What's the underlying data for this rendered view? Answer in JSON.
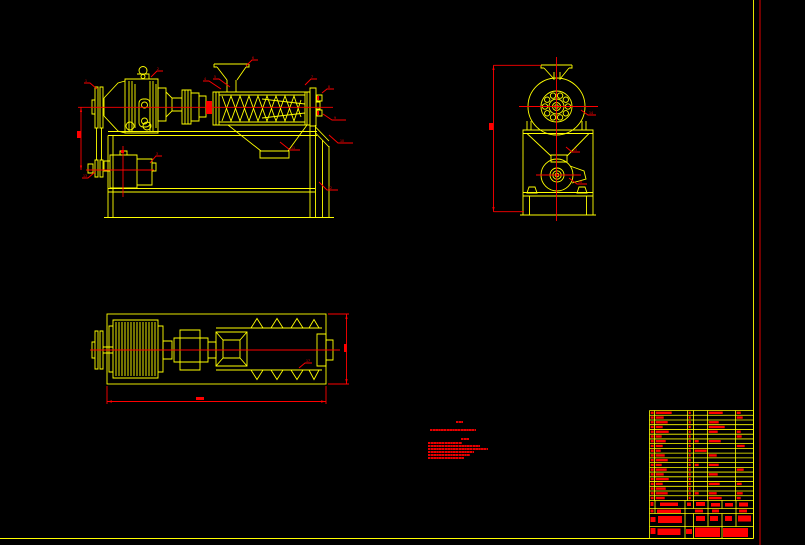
{
  "meta": {
    "background": "#000000",
    "line_color": "#ffff00",
    "accent_color": "#ff0000",
    "drawing_type": "CAD assembly drawing, screw press machine, three orthographic views",
    "text_legibility": "annotation text rendered too small to read at source resolution"
  },
  "sheet": {
    "border_right_x": 753.5,
    "border_bottom_y": 538.5,
    "outer_border_x": 760
  },
  "leaders": [
    {
      "n": "1",
      "pts": [
        [
          97,
          89
        ],
        [
          90,
          83
        ],
        [
          84,
          83
        ]
      ],
      "lx": 85,
      "ly": 82
    },
    {
      "n": "2",
      "pts": [
        [
          151,
          77
        ],
        [
          157,
          71
        ],
        [
          163,
          71
        ]
      ],
      "lx": 157,
      "ly": 70
    },
    {
      "n": "3",
      "pts": [
        [
          150,
          163
        ],
        [
          156,
          156
        ],
        [
          162,
          156
        ]
      ],
      "lx": 156,
      "ly": 155
    },
    {
      "n": "4",
      "pts": [
        [
          221,
          89
        ],
        [
          209,
          81
        ],
        [
          203,
          81
        ]
      ],
      "lx": 204,
      "ly": 80
    },
    {
      "n": "5",
      "pts": [
        [
          230,
          87
        ],
        [
          219,
          79
        ],
        [
          213,
          79
        ]
      ],
      "lx": 214,
      "ly": 78
    },
    {
      "n": "6",
      "pts": [
        [
          246,
          66
        ],
        [
          252,
          60
        ],
        [
          258,
          60
        ]
      ],
      "lx": 252,
      "ly": 59
    },
    {
      "n": "7",
      "pts": [
        [
          305,
          85
        ],
        [
          311,
          79
        ],
        [
          317,
          79
        ]
      ],
      "lx": 311,
      "ly": 78
    },
    {
      "n": "8",
      "pts": [
        [
          322,
          93
        ],
        [
          327,
          89
        ],
        [
          334,
          89
        ]
      ],
      "lx": 328,
      "ly": 88
    },
    {
      "n": "9",
      "pts": [
        [
          323,
          114
        ],
        [
          332,
          120
        ],
        [
          346,
          120
        ]
      ],
      "lx": 334,
      "ly": 119
    },
    {
      "n": "10",
      "pts": [
        [
          329,
          135
        ],
        [
          338,
          143
        ],
        [
          353,
          143
        ]
      ],
      "lx": 340,
      "ly": 142
    },
    {
      "n": "11",
      "pts": [
        [
          280,
          142
        ],
        [
          290,
          150
        ],
        [
          300,
          150
        ]
      ],
      "lx": 291,
      "ly": 149
    },
    {
      "n": "12",
      "pts": [
        [
          319,
          182
        ],
        [
          327,
          190
        ],
        [
          338,
          190
        ]
      ],
      "lx": 328,
      "ly": 189
    },
    {
      "n": "13",
      "pts": [
        [
          95,
          172
        ],
        [
          88,
          178
        ],
        [
          82,
          178
        ]
      ],
      "lx": 83,
      "ly": 177
    },
    {
      "n": "14",
      "pts": [
        [
          581,
          110
        ],
        [
          588,
          115
        ],
        [
          596,
          115
        ]
      ],
      "lx": 589,
      "ly": 114
    },
    {
      "n": "15",
      "pts": [
        [
          566,
          147
        ],
        [
          572,
          152
        ],
        [
          580,
          152
        ]
      ],
      "lx": 573,
      "ly": 151
    },
    {
      "n": "16",
      "pts": [
        [
          569,
          178
        ],
        [
          577,
          184
        ],
        [
          587,
          184
        ]
      ],
      "lx": 578,
      "ly": 183
    },
    {
      "n": "17",
      "pts": [
        [
          299,
          368
        ],
        [
          305,
          363
        ],
        [
          312,
          363
        ]
      ],
      "lx": 306,
      "ly": 362
    }
  ],
  "dim_texts": [
    [
      77,
      131,
      4,
      7
    ],
    [
      489,
      123,
      4,
      7
    ],
    [
      196,
      397,
      8,
      3
    ],
    [
      344,
      344,
      3,
      8
    ]
  ],
  "marks": [
    [
      206,
      101,
      6,
      13
    ],
    [
      317,
      96,
      2,
      4
    ],
    [
      317,
      111,
      2,
      4
    ],
    [
      121,
      150,
      3,
      3
    ],
    [
      650.5,
      502,
      3,
      4
    ],
    [
      660,
      502.5,
      18,
      3.5
    ],
    [
      687,
      502.5,
      4,
      3.5
    ],
    [
      696,
      502,
      9,
      4
    ],
    [
      711,
      503,
      9,
      3.5
    ],
    [
      725,
      503,
      8,
      3.5
    ],
    [
      739,
      502.5,
      9,
      4
    ],
    [
      650.5,
      509.5,
      3,
      3
    ],
    [
      657,
      509.5,
      24,
      3.5
    ],
    [
      695,
      509.5,
      8,
      3
    ],
    [
      712,
      509.5,
      7,
      3
    ],
    [
      739,
      509.5,
      8,
      3
    ],
    [
      658,
      516,
      24,
      7
    ],
    [
      650.5,
      517,
      5,
      5
    ],
    [
      696,
      516,
      9,
      5
    ],
    [
      710,
      516,
      8,
      5
    ],
    [
      725,
      516,
      7,
      5
    ],
    [
      738,
      515.5,
      13,
      6
    ],
    [
      650.5,
      528,
      5,
      6
    ],
    [
      657.5,
      528.5,
      23,
      6.5
    ],
    [
      686,
      529,
      6,
      5
    ],
    [
      695,
      527.5,
      25,
      9.5
    ],
    [
      723,
      528,
      25,
      9
    ]
  ],
  "notes": {
    "lines": [
      [
        456,
        420.5,
        7,
        2.5
      ],
      [
        430,
        428.5,
        46,
        2.5
      ],
      [
        461,
        437.5,
        8,
        2.5
      ],
      [
        428,
        441.5,
        34,
        2.3
      ],
      [
        428,
        444.6,
        52,
        2.3
      ],
      [
        428,
        447.7,
        60,
        2.3
      ],
      [
        428,
        450.8,
        46,
        2.3
      ],
      [
        428,
        453.9,
        42,
        2.3
      ],
      [
        428,
        457,
        36,
        2.3
      ]
    ]
  },
  "titleblock": {
    "x": 649.5,
    "y": 410.5,
    "w": 104,
    "rowH": 4.737,
    "rowCount": 19,
    "cols": [
      0,
      5,
      38,
      44,
      58,
      86,
      104
    ],
    "rows": [
      [
        3,
        16,
        2,
        0,
        14,
        4
      ],
      [
        3,
        8,
        2,
        0,
        0,
        6
      ],
      [
        3,
        12,
        2,
        0,
        10,
        0
      ],
      [
        3,
        7,
        2,
        0,
        16,
        0
      ],
      [
        3,
        13,
        2,
        0,
        9,
        4
      ],
      [
        3,
        6,
        2,
        0,
        0,
        5
      ],
      [
        3,
        10,
        2,
        4,
        12,
        0
      ],
      [
        3,
        7,
        2,
        0,
        0,
        8
      ],
      [
        3,
        5,
        2,
        12,
        0,
        0
      ],
      [
        3,
        9,
        2,
        0,
        8,
        0
      ],
      [
        3,
        12,
        2,
        0,
        0,
        0
      ],
      [
        3,
        6,
        2,
        4,
        10,
        0
      ],
      [
        3,
        11,
        2,
        0,
        0,
        7
      ],
      [
        3,
        8,
        2,
        0,
        9,
        0
      ],
      [
        3,
        13,
        2,
        0,
        0,
        0
      ],
      [
        3,
        7,
        2,
        0,
        11,
        5
      ],
      [
        3,
        10,
        2,
        0,
        0,
        0
      ],
      [
        3,
        12,
        2,
        4,
        8,
        6
      ],
      [
        3,
        9,
        2,
        0,
        13,
        4
      ]
    ]
  }
}
